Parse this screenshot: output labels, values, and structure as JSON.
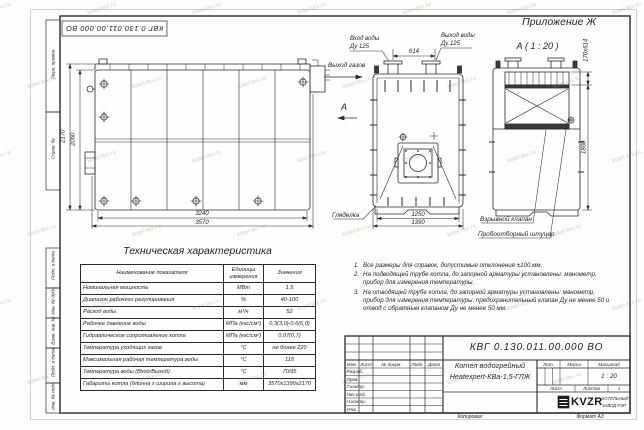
{
  "document": {
    "appendix_label": "Приложение Ж",
    "doc_number": "КВГ 0.130.011.00.000 ВО",
    "copied_label": "Копировал",
    "format_label": "Формат А3"
  },
  "watermark": {
    "text": "kotel-tex.ru"
  },
  "margin_fields": [
    "Перв. примен.",
    "Справ. №",
    "Подп. и дата",
    "Инв. № дубл.",
    "Взам. инв. №",
    "Подп. и дата",
    "Инв. № подл."
  ],
  "views": {
    "side": {
      "dim_width_inner": "3240",
      "dim_width_outer": "3570",
      "dim_height_outer": "2170",
      "dim_height_inner": "2060",
      "gas_outlet_label": "Выход газов",
      "view_direction_label": "А"
    },
    "front": {
      "dim_pipe_spacing": "614",
      "dim_width_inner": "1250",
      "dim_width_outer": "1390",
      "water_in_label": "Вход воды",
      "water_in_dn": "Ду 125",
      "water_out_label": "Выход воды",
      "water_out_dn": "Ду 125",
      "sight_glass_label": "Гляделка"
    },
    "rear": {
      "view_title": "А ( 1 : 20 )",
      "dim_valve": "170х614",
      "dim_height": "1860",
      "explosion_valve_label": "Взрывной клапан",
      "sampling_fitting_label": "Пробоотборный штуцер"
    }
  },
  "spec_table": {
    "title": "Техническая характеристика",
    "headers": [
      "Наименование показателя",
      "Единицы измерения",
      "Значения"
    ],
    "rows": [
      {
        "name": "Номинальная мощность",
        "unit": "МВт",
        "value": "1,5"
      },
      {
        "name": "Диапазон рабочего регулирования",
        "unit": "%",
        "value": "40-100"
      },
      {
        "name": "Расход воды",
        "unit": "м³/ч",
        "value": "52"
      },
      {
        "name": "Рабочее давление воды",
        "unit": "МПа (кгс/см²)",
        "value": "0,3(3,0)-0,6(6,0)"
      },
      {
        "name": "Гидравлическое сопротивление котла",
        "unit": "МПа (кгс/см²)",
        "value": "0,07(0,7)"
      },
      {
        "name": "Температура уходящих газов",
        "unit": "°С",
        "value": "не более 220"
      },
      {
        "name": "Максимальная рабочая температура воды",
        "unit": "°С",
        "value": "115"
      },
      {
        "name": "Температура воды (Вход/Выход)",
        "unit": "°С",
        "value": "70/95"
      },
      {
        "name": "Габариты котла (длинна х ширина х высота)",
        "unit": "мм",
        "value": "3570х1390х2170"
      }
    ]
  },
  "notes": {
    "items": [
      {
        "num": "1.",
        "text": "Все размеры для справок, допустимые отклонения ±100 мм."
      },
      {
        "num": "2.",
        "text": "На подводящей трубе котла, до запорной арматуры установлены: манометр, прибор для измерения температуры."
      },
      {
        "num": "3.",
        "text": "На отводящей трубе котла, до запорной арматуры установлены: манометр, прибор для измерения температуры, предохранительный клапан Ду не менее 50 и отвод с обратным клапаном Ду не менее 50 мм."
      }
    ]
  },
  "title_block": {
    "doc_number": "КВГ 0.130.011.00.000 ВО",
    "product_name_line1": "Котел водогрейный",
    "product_name_line2": "Heatexpert-КВа-1,5-ГЛЖ",
    "columns": [
      "Изм.",
      "Лист",
      "№ докум.",
      "Подп.",
      "Дата"
    ],
    "signature_rows": [
      "Разраб.",
      "Пров.",
      "Т.контр.",
      "Нач.отд.",
      "Н.контр.",
      "Утв."
    ],
    "lit_label": "Лит.",
    "mass_label": "Масса",
    "scale_label": "Масштаб",
    "scale_value": "1 : 20",
    "sheet_label": "Лист",
    "sheets_label": "Листов",
    "sheets_value": "1",
    "logo_text": "KVZR",
    "org_name_line1": "КОТЕЛЬНЫЙ",
    "org_name_line2": "ЗАВОД РЭП"
  }
}
